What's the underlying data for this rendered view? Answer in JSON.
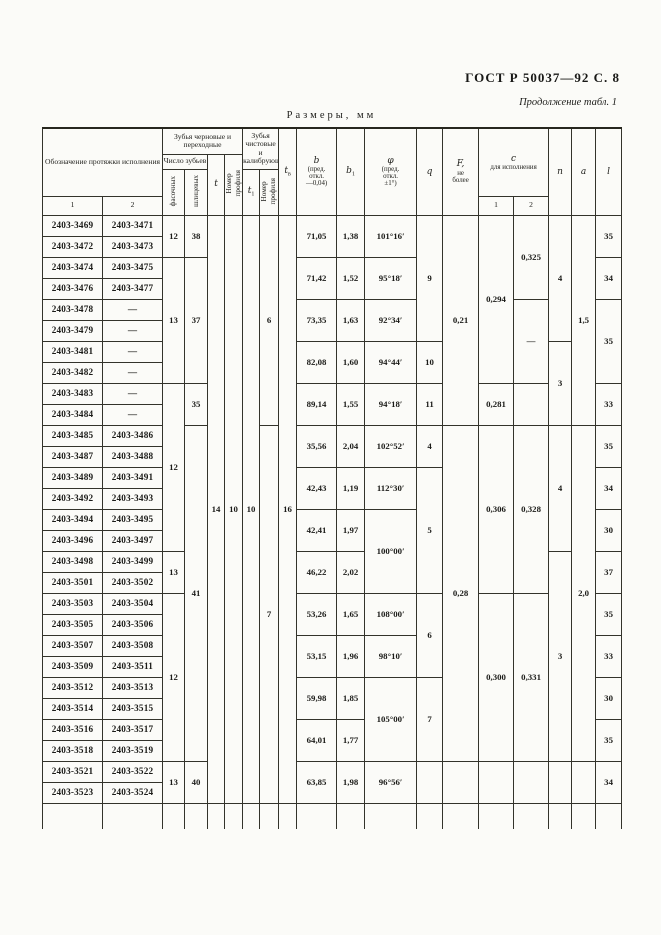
{
  "page": {
    "gost_header": "ГОСТ Р 50037—92 С. 8",
    "continuation": "Продолжение табл. 1",
    "size_label": "Размеры, мм"
  },
  "table": {
    "headers": {
      "designation": "Обозначение протяжки исполнения",
      "designation_sub1": "1",
      "designation_sub2": "2",
      "rough_group": "Зубья черновые и переходные",
      "teeth_count": "Число зубьев",
      "chamfer": "фасочных",
      "spline": "шлицевых",
      "t_sym": "t",
      "profile_no1": "Номер\nпрофиля",
      "finish_group": "Зубья чистовые и калибрующие",
      "t1_sym": "t",
      "t1_sub": "1",
      "profile_no2": "Номер\nпрофиля",
      "tv_sym": "t",
      "tv_sub": "в",
      "b_sym": "b",
      "b_note": "(пред.\nоткл.\n—0,04)",
      "b1_sym": "b",
      "b1_sub": "1",
      "phi_sym": "φ",
      "phi_note": "(пред.\nоткл.\n±1°)",
      "q_sym": "q",
      "f_sym": "F,",
      "f_note": "не\nболее",
      "c_sym": "с",
      "c_note": "для исполнения",
      "c_sub1": "1",
      "c_sub2": "2",
      "n_sym": "n",
      "a_sym": "a",
      "l_sym": "l"
    },
    "body": {
      "row_count": 28,
      "columns": [
        {
          "key": "d1",
          "cells": [
            {
              "r": 1,
              "v": "2403-3469"
            },
            {
              "r": 1,
              "v": "2403-3472"
            },
            {
              "r": 1,
              "v": "2403-3474"
            },
            {
              "r": 1,
              "v": "2403-3476"
            },
            {
              "r": 1,
              "v": "2403-3478"
            },
            {
              "r": 1,
              "v": "2403-3479"
            },
            {
              "r": 1,
              "v": "2403-3481"
            },
            {
              "r": 1,
              "v": "2403-3482"
            },
            {
              "r": 1,
              "v": "2403-3483"
            },
            {
              "r": 1,
              "v": "2403-3484"
            },
            {
              "r": 1,
              "v": "2403-3485"
            },
            {
              "r": 1,
              "v": "2403-3487"
            },
            {
              "r": 1,
              "v": "2403-3489"
            },
            {
              "r": 1,
              "v": "2403-3492"
            },
            {
              "r": 1,
              "v": "2403-3494"
            },
            {
              "r": 1,
              "v": "2403-3496"
            },
            {
              "r": 1,
              "v": "2403-3498"
            },
            {
              "r": 1,
              "v": "2403-3501"
            },
            {
              "r": 1,
              "v": "2403-3503"
            },
            {
              "r": 1,
              "v": "2403-3505"
            },
            {
              "r": 1,
              "v": "2403-3507"
            },
            {
              "r": 1,
              "v": "2403-3509"
            },
            {
              "r": 1,
              "v": "2403-3512"
            },
            {
              "r": 1,
              "v": "2403-3514"
            },
            {
              "r": 1,
              "v": "2403-3516"
            },
            {
              "r": 1,
              "v": "2403-3518"
            },
            {
              "r": 1,
              "v": "2403-3521"
            },
            {
              "r": 1,
              "v": "2403-3523"
            }
          ]
        },
        {
          "key": "d2",
          "cells": [
            {
              "r": 1,
              "v": "2403-3471"
            },
            {
              "r": 1,
              "v": "2403-3473"
            },
            {
              "r": 1,
              "v": "2403-3475"
            },
            {
              "r": 1,
              "v": "2403-3477"
            },
            {
              "r": 1,
              "v": "—"
            },
            {
              "r": 1,
              "v": "—"
            },
            {
              "r": 1,
              "v": "—"
            },
            {
              "r": 1,
              "v": "—"
            },
            {
              "r": 1,
              "v": "—"
            },
            {
              "r": 1,
              "v": "—"
            },
            {
              "r": 1,
              "v": "2403-3486"
            },
            {
              "r": 1,
              "v": "2403-3488"
            },
            {
              "r": 1,
              "v": "2403-3491"
            },
            {
              "r": 1,
              "v": "2403-3493"
            },
            {
              "r": 1,
              "v": "2403-3495"
            },
            {
              "r": 1,
              "v": "2403-3497"
            },
            {
              "r": 1,
              "v": "2403-3499"
            },
            {
              "r": 1,
              "v": "2403-3502"
            },
            {
              "r": 1,
              "v": "2403-3504"
            },
            {
              "r": 1,
              "v": "2403-3506"
            },
            {
              "r": 1,
              "v": "2403-3508"
            },
            {
              "r": 1,
              "v": "2403-3511"
            },
            {
              "r": 1,
              "v": "2403-3513"
            },
            {
              "r": 1,
              "v": "2403-3515"
            },
            {
              "r": 1,
              "v": "2403-3517"
            },
            {
              "r": 1,
              "v": "2403-3519"
            },
            {
              "r": 1,
              "v": "2403-3522"
            },
            {
              "r": 1,
              "v": "2403-3524"
            }
          ]
        },
        {
          "key": "fas",
          "cells": [
            {
              "r": 2,
              "v": "12"
            },
            {
              "r": 6,
              "v": "13"
            },
            {
              "r": 8,
              "v": "12"
            },
            {
              "r": 2,
              "v": "13"
            },
            {
              "r": 8,
              "v": "12"
            },
            {
              "r": 2,
              "v": "13"
            }
          ]
        },
        {
          "key": "shl",
          "cells": [
            {
              "r": 2,
              "v": "38"
            },
            {
              "r": 6,
              "v": "37"
            },
            {
              "r": 2,
              "v": "35"
            },
            {
              "r": 16,
              "v": "41"
            },
            {
              "r": 2,
              "v": "40"
            }
          ]
        },
        {
          "key": "t",
          "cells": [
            {
              "r": 28,
              "v": "14"
            }
          ]
        },
        {
          "key": "np1",
          "cells": [
            {
              "r": 28,
              "v": "10"
            }
          ]
        },
        {
          "key": "t1",
          "cells": [
            {
              "r": 28,
              "v": "10"
            }
          ]
        },
        {
          "key": "np2",
          "cells": [
            {
              "r": 10,
              "v": "6"
            },
            {
              "r": 18,
              "v": "7"
            }
          ]
        },
        {
          "key": "tv",
          "cells": [
            {
              "r": 28,
              "v": "16"
            }
          ]
        },
        {
          "key": "b",
          "cells": [
            {
              "r": 2,
              "v": "71,05"
            },
            {
              "r": 2,
              "v": "71,42"
            },
            {
              "r": 2,
              "v": "73,35"
            },
            {
              "r": 2,
              "v": "82,08"
            },
            {
              "r": 2,
              "v": "89,14"
            },
            {
              "r": 2,
              "v": "35,56"
            },
            {
              "r": 2,
              "v": "42,43"
            },
            {
              "r": 2,
              "v": "42,41"
            },
            {
              "r": 2,
              "v": "46,22"
            },
            {
              "r": 2,
              "v": "53,26"
            },
            {
              "r": 2,
              "v": "53,15"
            },
            {
              "r": 2,
              "v": "59,98"
            },
            {
              "r": 2,
              "v": "64,01"
            },
            {
              "r": 2,
              "v": "63,85"
            }
          ]
        },
        {
          "key": "b1",
          "cells": [
            {
              "r": 2,
              "v": "1,38"
            },
            {
              "r": 2,
              "v": "1,52"
            },
            {
              "r": 2,
              "v": "1,63"
            },
            {
              "r": 2,
              "v": "1,60"
            },
            {
              "r": 2,
              "v": "1,55"
            },
            {
              "r": 2,
              "v": "2,04"
            },
            {
              "r": 2,
              "v": "1,19"
            },
            {
              "r": 2,
              "v": "1,97"
            },
            {
              "r": 2,
              "v": "2,02"
            },
            {
              "r": 2,
              "v": "1,65"
            },
            {
              "r": 2,
              "v": "1,96"
            },
            {
              "r": 2,
              "v": "1,85"
            },
            {
              "r": 2,
              "v": "1,77"
            },
            {
              "r": 2,
              "v": "1,98"
            }
          ]
        },
        {
          "key": "phi",
          "cells": [
            {
              "r": 2,
              "v": "101°16′"
            },
            {
              "r": 2,
              "v": "95°18′"
            },
            {
              "r": 2,
              "v": "92°34′"
            },
            {
              "r": 2,
              "v": "94°44′"
            },
            {
              "r": 2,
              "v": "94°18′"
            },
            {
              "r": 2,
              "v": "102°52′"
            },
            {
              "r": 2,
              "v": "112°30′"
            },
            {
              "r": 4,
              "v": "100°00′"
            },
            {
              "r": 2,
              "v": "108°00′"
            },
            {
              "r": 2,
              "v": "98°10′"
            },
            {
              "r": 4,
              "v": "105°00′"
            },
            {
              "r": 2,
              "v": "96°56′"
            }
          ]
        },
        {
          "key": "q",
          "cells": [
            {
              "r": 6,
              "v": "9"
            },
            {
              "r": 2,
              "v": "10"
            },
            {
              "r": 2,
              "v": "11"
            },
            {
              "r": 2,
              "v": "4"
            },
            {
              "r": 6,
              "v": "5"
            },
            {
              "r": 4,
              "v": "6"
            },
            {
              "r": 4,
              "v": "7"
            },
            {
              "r": 2,
              "v": ""
            }
          ]
        },
        {
          "key": "F",
          "cells": [
            {
              "r": 10,
              "v": "0,21"
            },
            {
              "r": 16,
              "v": "0,28"
            },
            {
              "r": 2,
              "v": ""
            }
          ]
        },
        {
          "key": "c1",
          "cells": [
            {
              "r": 8,
              "v": "0,294"
            },
            {
              "r": 2,
              "v": "0,281"
            },
            {
              "r": 8,
              "v": "0,306"
            },
            {
              "r": 8,
              "v": "0,300"
            },
            {
              "r": 2,
              "v": ""
            }
          ]
        },
        {
          "key": "c2",
          "cells": [
            {
              "r": 4,
              "v": "0,325"
            },
            {
              "r": 4,
              "v": "—"
            },
            {
              "r": 2,
              "v": ""
            },
            {
              "r": 8,
              "v": "0,328"
            },
            {
              "r": 8,
              "v": "0,331"
            },
            {
              "r": 2,
              "v": ""
            }
          ]
        },
        {
          "key": "n",
          "cells": [
            {
              "r": 6,
              "v": "4"
            },
            {
              "r": 4,
              "v": "3"
            },
            {
              "r": 6,
              "v": "4"
            },
            {
              "r": 10,
              "v": "3"
            },
            {
              "r": 2,
              "v": ""
            }
          ]
        },
        {
          "key": "a",
          "cells": [
            {
              "r": 10,
              "v": "1,5"
            },
            {
              "r": 16,
              "v": "2,0"
            },
            {
              "r": 2,
              "v": ""
            }
          ]
        },
        {
          "key": "l",
          "cells": [
            {
              "r": 2,
              "v": "35"
            },
            {
              "r": 2,
              "v": "34"
            },
            {
              "r": 4,
              "v": "35"
            },
            {
              "r": 2,
              "v": "33"
            },
            {
              "r": 2,
              "v": "35"
            },
            {
              "r": 2,
              "v": "34"
            },
            {
              "r": 2,
              "v": "30"
            },
            {
              "r": 2,
              "v": "37"
            },
            {
              "r": 2,
              "v": "35"
            },
            {
              "r": 2,
              "v": "33"
            },
            {
              "r": 2,
              "v": "30"
            },
            {
              "r": 2,
              "v": "35"
            },
            {
              "r": 2,
              "v": "34"
            }
          ]
        }
      ]
    }
  }
}
